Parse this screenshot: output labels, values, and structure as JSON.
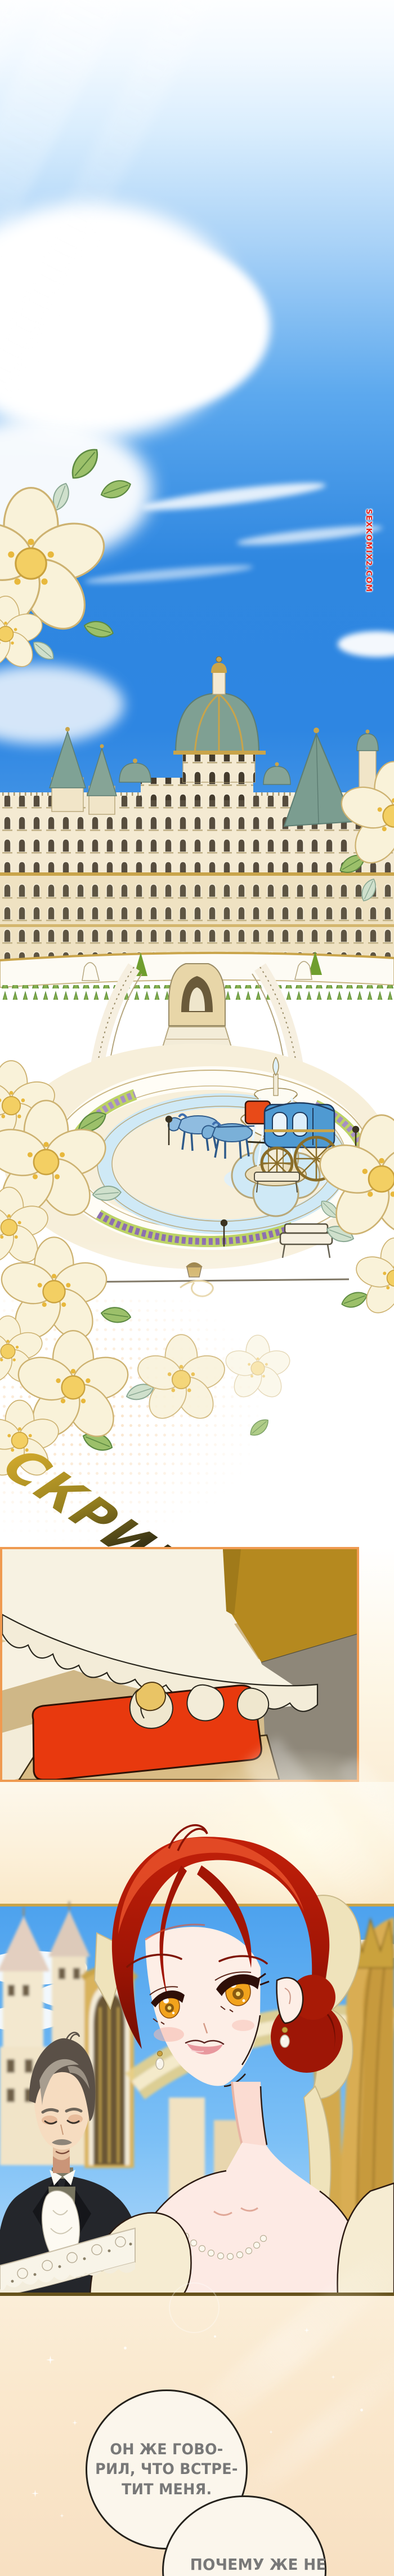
{
  "watermark": {
    "text": "SEXKOMIX2.COM",
    "color": "#e8231a"
  },
  "sfx": {
    "text": "СКРИП",
    "gradient_from": "#cfa82c",
    "gradient_to": "#1d1b0e"
  },
  "dialogue": {
    "text_color": "#787878",
    "bubbles": [
      {
        "lines": [
          "ОН ЖЕ ГОВО-",
          "РИЛ, ЧТО ВСТРЕ-",
          "ТИТ МЕНЯ."
        ]
      },
      {
        "lines": [
          "ПОЧЕМУ ЖЕ НЕ"
        ]
      }
    ]
  },
  "colors": {
    "panel_border": "#ef9a50",
    "divider_line": "#66521c",
    "step_red": "#e8390e",
    "sky_blue": "#2f87e0",
    "curtain_gold": "#d9ad52",
    "hair_red": "#b51c08",
    "eye_amber": "#f2a31c",
    "bubble_fill": "#fbf6ec"
  }
}
